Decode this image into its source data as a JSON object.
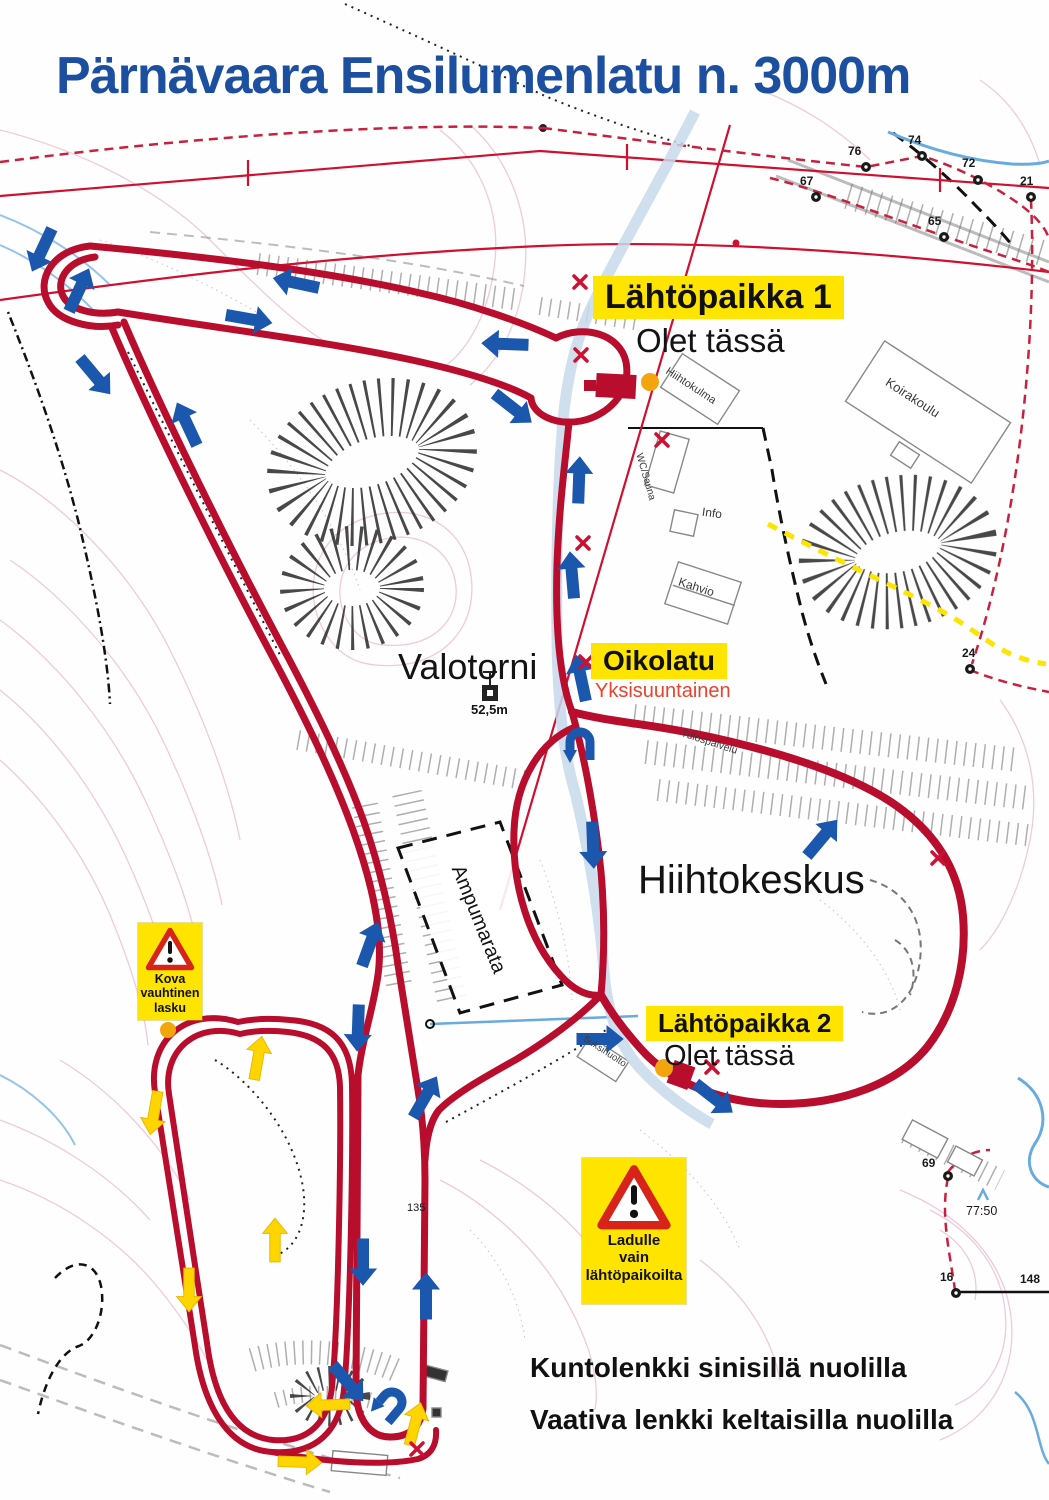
{
  "title": "Pärnävaara Ensilumenlatu n. 3000m",
  "map": {
    "start1": {
      "label": "Lähtöpaikka 1",
      "you_are_here": "Olet tässä"
    },
    "start2": {
      "label": "Lähtöpaikka 2",
      "you_are_here": "Olet tässä"
    },
    "shortcut": {
      "label": "Oikolatu",
      "sublabel": "Yksisuuntainen"
    },
    "places": {
      "valotorni": "Valotorni",
      "hiihtokeskus": "Hiihtokeskus",
      "ampumarata": "Ampumarata",
      "tower_height": "52,5m",
      "spot_height": "77:50",
      "elevation_135": "135"
    },
    "buildings": {
      "hiihtokulma": "Hiihtokulma",
      "wc_sauna": "WC/Sauna",
      "info": "Info",
      "kahvio": "Kahvio",
      "koirakoulu": "Koirakoulu",
      "tulospalvelu": "Tulospalvelu",
      "suksihuolto": "Suksihuolto"
    },
    "warnings": {
      "downhill": {
        "lines": [
          "Kova",
          "vauhtinen",
          "lasku"
        ]
      },
      "access": {
        "lines": [
          "Ladulle",
          "vain",
          "lähtöpaikoilta"
        ]
      }
    },
    "markers": {
      "k76": "76",
      "k74": "74",
      "k72": "72",
      "k67": "67",
      "k65": "65",
      "k21": "21",
      "k24": "24",
      "k69": "69",
      "k16": "16",
      "k148": "148"
    }
  },
  "legend": {
    "line1": "Kuntolenkki sinisillä nuolilla",
    "line2": "Vaativa lenkki keltaisilla nuolilla"
  },
  "icons": {
    "blue_arrow": "fitness-loop direction arrow",
    "yellow_arrow": "demanding-loop direction arrow",
    "uturn_arrow": "u-turn direction arrow",
    "warning_triangle": "warning triangle",
    "orange_dot": "you-are-here dot",
    "red_x": "trail closed marker",
    "tower": "light tower symbol"
  },
  "colors": {
    "title_blue": "#1d4fa0",
    "trail_red": "#b80d2c",
    "arrow_blue": "#1c57ae",
    "arrow_yellow": "#ffd500",
    "label_yellow_bg": "#ffe400",
    "warning_red": "#d8231a",
    "one_way_red": "#e8432e",
    "marker_orange": "#f2a50c"
  }
}
